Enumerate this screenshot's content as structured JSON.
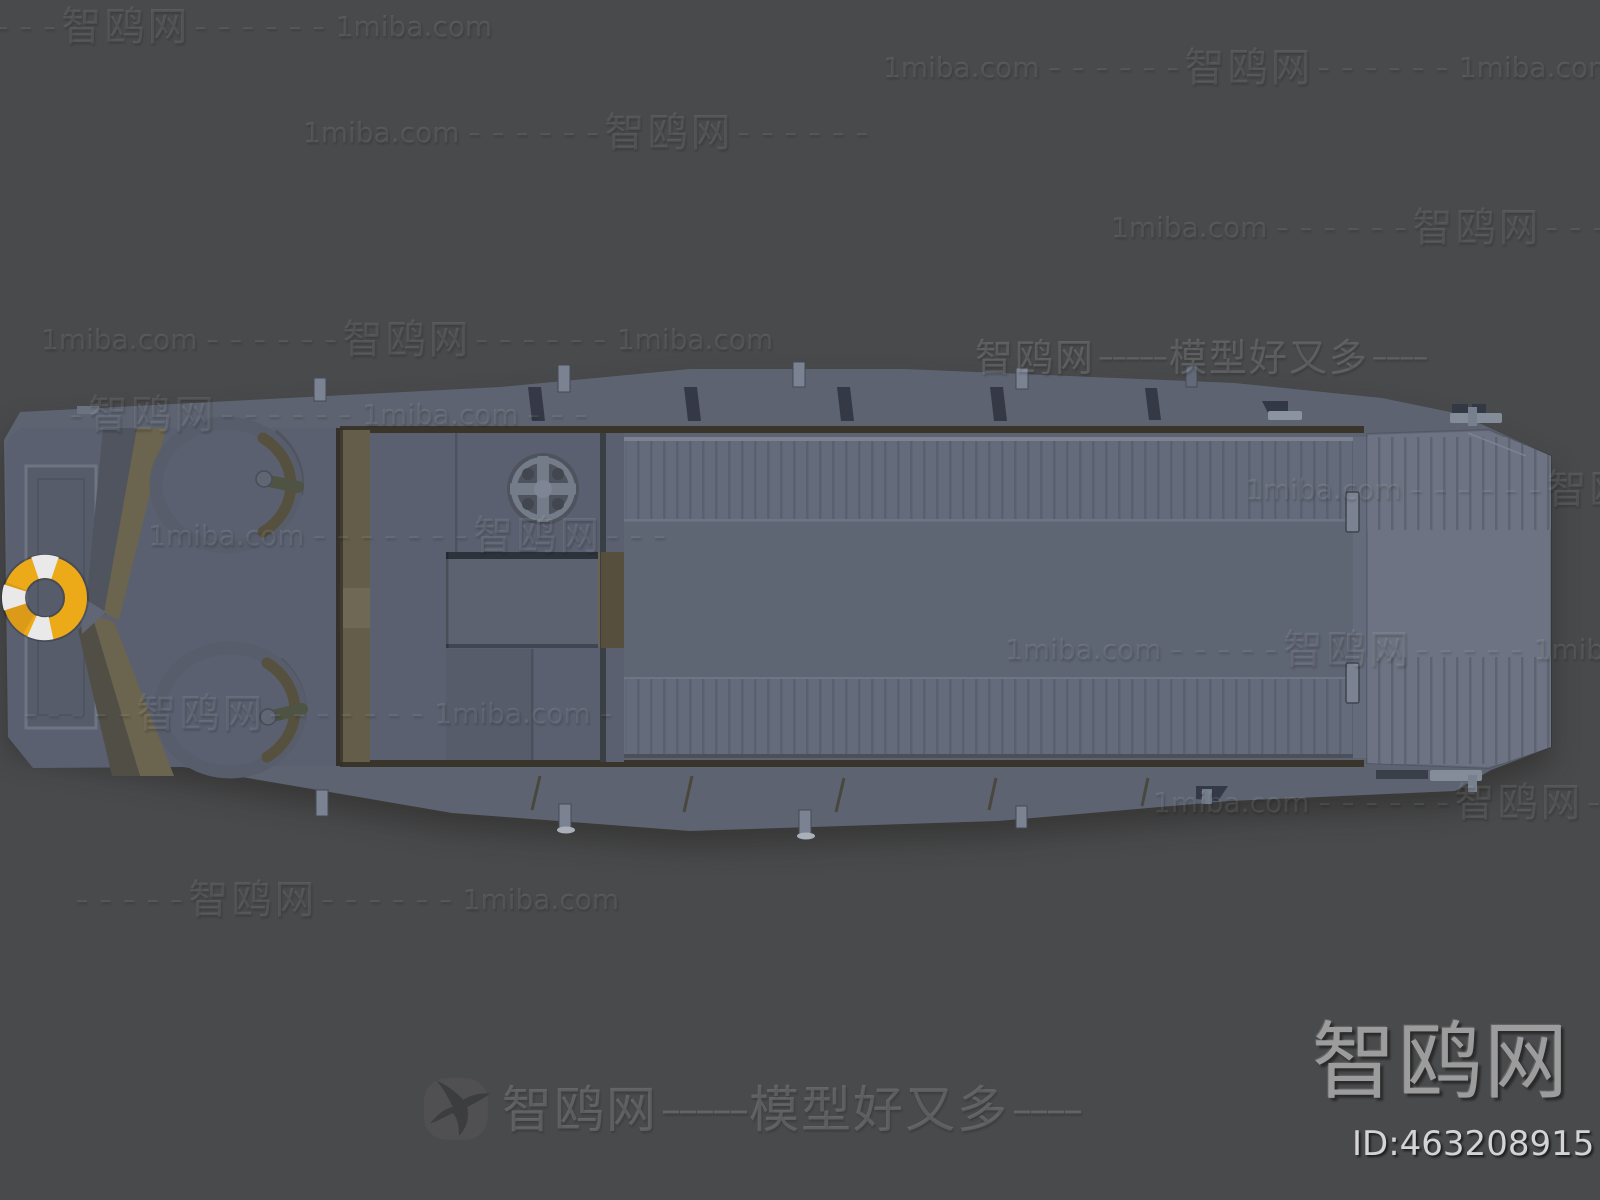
{
  "page": {
    "width": 1600,
    "height": 1200
  },
  "branding": {
    "site_name": "智鸥网",
    "site_domain": "1miba.com",
    "slogan": "模型好又多",
    "logo_text": "智鸥网",
    "model_id": "ID:463208915"
  },
  "watermarks": {
    "rows": [
      {
        "x": -55,
        "y": 27,
        "segs": [
          [
            "d",
            "– – – – –"
          ],
          [
            "c",
            "智鸥网"
          ],
          [
            "d",
            "– – – – – –"
          ],
          [
            "l",
            "1miba.com"
          ]
        ]
      },
      {
        "x": 878,
        "y": 68,
        "segs": [
          [
            "l",
            "1miba.com"
          ],
          [
            "d",
            "– – – – – –"
          ],
          [
            "c",
            "智鸥网"
          ],
          [
            "d",
            "– – – – – –"
          ],
          [
            "l",
            "1miba.com"
          ],
          [
            "d",
            "– –"
          ]
        ]
      },
      {
        "x": 298,
        "y": 133,
        "segs": [
          [
            "l",
            "1miba.com"
          ],
          [
            "d",
            "– – – – – –"
          ],
          [
            "c",
            "智鸥网"
          ],
          [
            "d",
            "– – – – – –"
          ]
        ]
      },
      {
        "x": 1106,
        "y": 228,
        "segs": [
          [
            "l",
            "1miba.com"
          ],
          [
            "d",
            "– – – – – –"
          ],
          [
            "c",
            "智鸥网"
          ],
          [
            "d",
            "– – – – – –"
          ]
        ]
      },
      {
        "x": 36,
        "y": 340,
        "segs": [
          [
            "l",
            "1miba.com"
          ],
          [
            "d",
            "– – – – – –"
          ],
          [
            "c",
            "智鸥网"
          ],
          [
            "d",
            "– – – – – –"
          ],
          [
            "l",
            "1miba.com"
          ]
        ]
      },
      {
        "x": 975,
        "y": 358,
        "bright": true,
        "segs": [
          [
            "c",
            "智鸥网"
          ],
          [
            "d2",
            "–––––"
          ],
          [
            "c",
            "模型好又多"
          ],
          [
            "d2",
            "––––"
          ]
        ]
      },
      {
        "x": 66,
        "y": 415,
        "segs": [
          [
            "d",
            "–"
          ],
          [
            "c",
            "智鸥网"
          ],
          [
            "d",
            "– – – – – –"
          ],
          [
            "l",
            "1miba.com"
          ],
          [
            "d",
            "– – –"
          ]
        ]
      },
      {
        "x": 1240,
        "y": 490,
        "segs": [
          [
            "l",
            "1miba.com"
          ],
          [
            "d",
            "– – – – – –"
          ],
          [
            "c",
            "智鸥网"
          ],
          [
            "d",
            "–"
          ]
        ]
      },
      {
        "x": 143,
        "y": 536,
        "segs": [
          [
            "l",
            "1miba.com"
          ],
          [
            "d",
            "– – – – – – –"
          ],
          [
            "c",
            "智鸥网"
          ],
          [
            "d",
            "– – –"
          ]
        ]
      },
      {
        "x": 1000,
        "y": 650,
        "segs": [
          [
            "l",
            "1miba.com"
          ],
          [
            "d",
            "– – – – –"
          ],
          [
            "c",
            "智鸥网"
          ],
          [
            "d",
            "– – – – –"
          ],
          [
            "l",
            "1miba.com"
          ]
        ]
      },
      {
        "x": 20,
        "y": 714,
        "segs": [
          [
            "d",
            "– – – – –"
          ],
          [
            "c",
            "智鸥网"
          ],
          [
            "d",
            "– – – – – – –"
          ],
          [
            "l",
            "1miba.com"
          ],
          [
            "d",
            "–"
          ]
        ]
      },
      {
        "x": 1148,
        "y": 803,
        "segs": [
          [
            "l",
            "1miba.com"
          ],
          [
            "d",
            "– – – – – –"
          ],
          [
            "c",
            "智鸥网"
          ],
          [
            "d",
            "– – – – –"
          ]
        ]
      },
      {
        "x": 72,
        "y": 900,
        "segs": [
          [
            "d",
            "– – – – –"
          ],
          [
            "c",
            "智鸥网"
          ],
          [
            "d",
            "– – – – – –"
          ],
          [
            "l",
            "1miba.com"
          ]
        ]
      }
    ],
    "footer": {
      "x": 502,
      "y": 1110,
      "segs": [
        [
          "c",
          "智鸥网"
        ],
        [
          "d2",
          "–––––"
        ],
        [
          "c",
          "模型好又多"
        ],
        [
          "d2",
          "––––"
        ]
      ]
    }
  },
  "colors": {
    "background": "#494a4c",
    "hull": "#5d6371",
    "deck": "#5a6070",
    "deck_dark": "#565c6a",
    "cargo": "#646b7a",
    "cargo_mid": "#5e6573",
    "cargo_light": "#7c8292",
    "rib": "#59606f",
    "ramp": "#6d7382",
    "khaki": "#6b644e",
    "khaki_dark": "#56503e",
    "brown": "#3a352b",
    "ring": "#575d6b",
    "slot": "#343945",
    "post": "#7b8292",
    "buoy_yellow": "#eca918",
    "buoy_shade": "#c8891b",
    "buoy_white": "#e9e9e9",
    "wheel": "#747b89",
    "watermark": "rgba(255,255,255,0.095)",
    "watermark_bright": "rgba(255,255,255,0.14)",
    "logo_gray": "#9c9c9c",
    "id_gray": "#d4d4d4"
  }
}
